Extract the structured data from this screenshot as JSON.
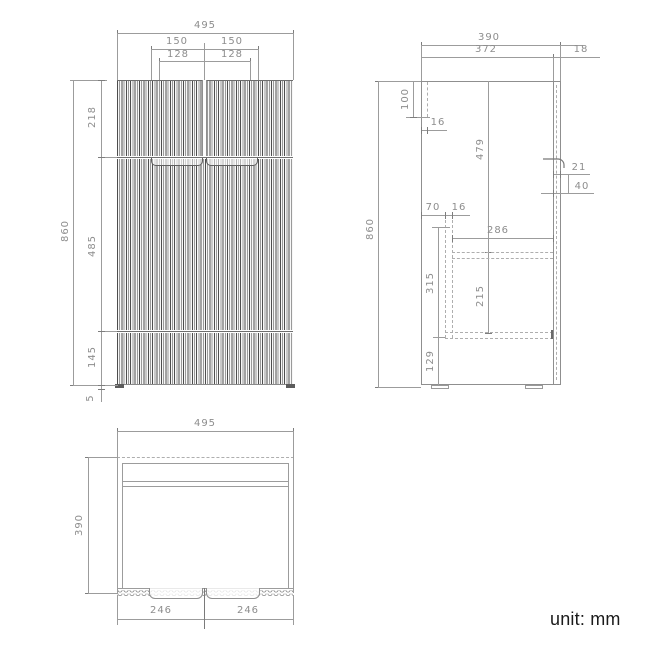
{
  "unit_label": "unit: mm",
  "drawing": {
    "type": "furniture dimension drawing",
    "line_color": "#9c9c9c",
    "text_color": "#8d8d8d"
  },
  "front": {
    "total_width": "495",
    "handle_left": "150",
    "handle_right": "150",
    "grip_left": "128",
    "grip_right": "128",
    "top_section": "218",
    "middle_section": "485",
    "bottom_section": "145",
    "plinth": "5",
    "total_height": "860"
  },
  "side": {
    "total_depth": "390",
    "carcass_depth": "372",
    "door_thickness": "18",
    "back_rail_height": "100",
    "back_rail_thickness": "16",
    "total_height": "860",
    "interior_height": "479",
    "handle_depth": "21",
    "handle_height": "40",
    "rail_offset": "70",
    "rail_thickness": "16",
    "shelf_depth": "286",
    "rail_length": "315",
    "shelf_height": "215",
    "bottom_clearance": "129"
  },
  "top": {
    "total_width": "495",
    "total_depth": "390",
    "door_left": "246",
    "door_right": "246"
  }
}
